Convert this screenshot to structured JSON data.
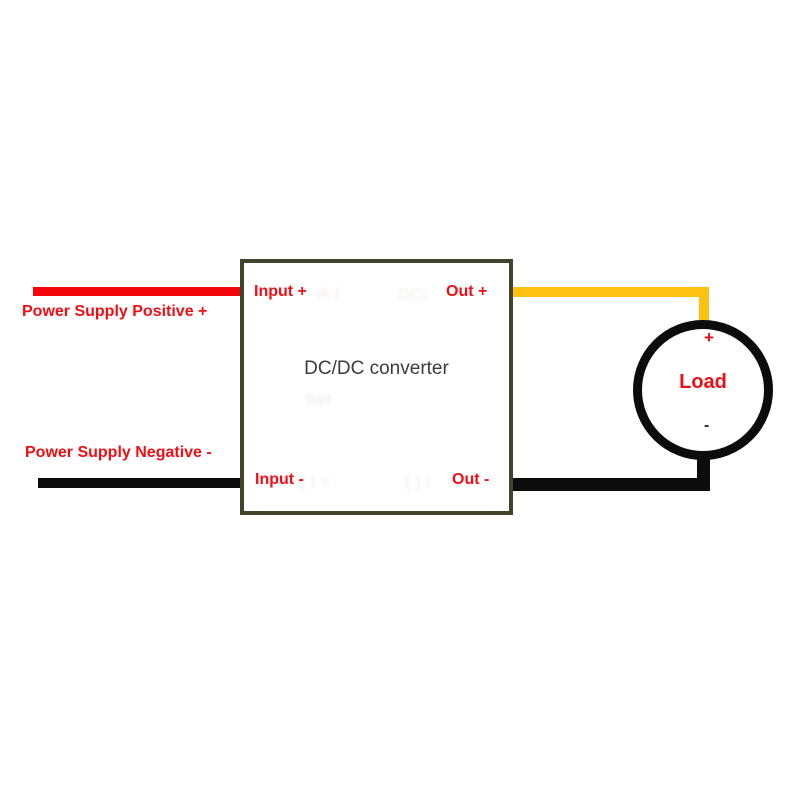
{
  "colors": {
    "wire_red": "#f2070d",
    "wire_yellow": "#ffc111",
    "wire_black": "#0c0c0c",
    "box_border": "#43432c",
    "label_red": "#ee0f16",
    "converter_text": "#3b3b3b"
  },
  "labels": {
    "power_supply_positive": "Power Supply Positive +",
    "power_supply_negative": "Power Supply Negative -",
    "input_plus": "Input +",
    "out_plus": "Out +",
    "input_minus": "Input -",
    "out_minus": "Out -",
    "converter": "DC/DC converter",
    "load": "Load",
    "load_positive": "+",
    "load_negative": "-"
  },
  "artifacts": {
    "ghost_top_1": "A /",
    "ghost_top_2": "DC/",
    "ghost_mid": "Set",
    "ghost_bottom_1": "( \\ =",
    "ghost_bottom_2": "( ) /"
  }
}
